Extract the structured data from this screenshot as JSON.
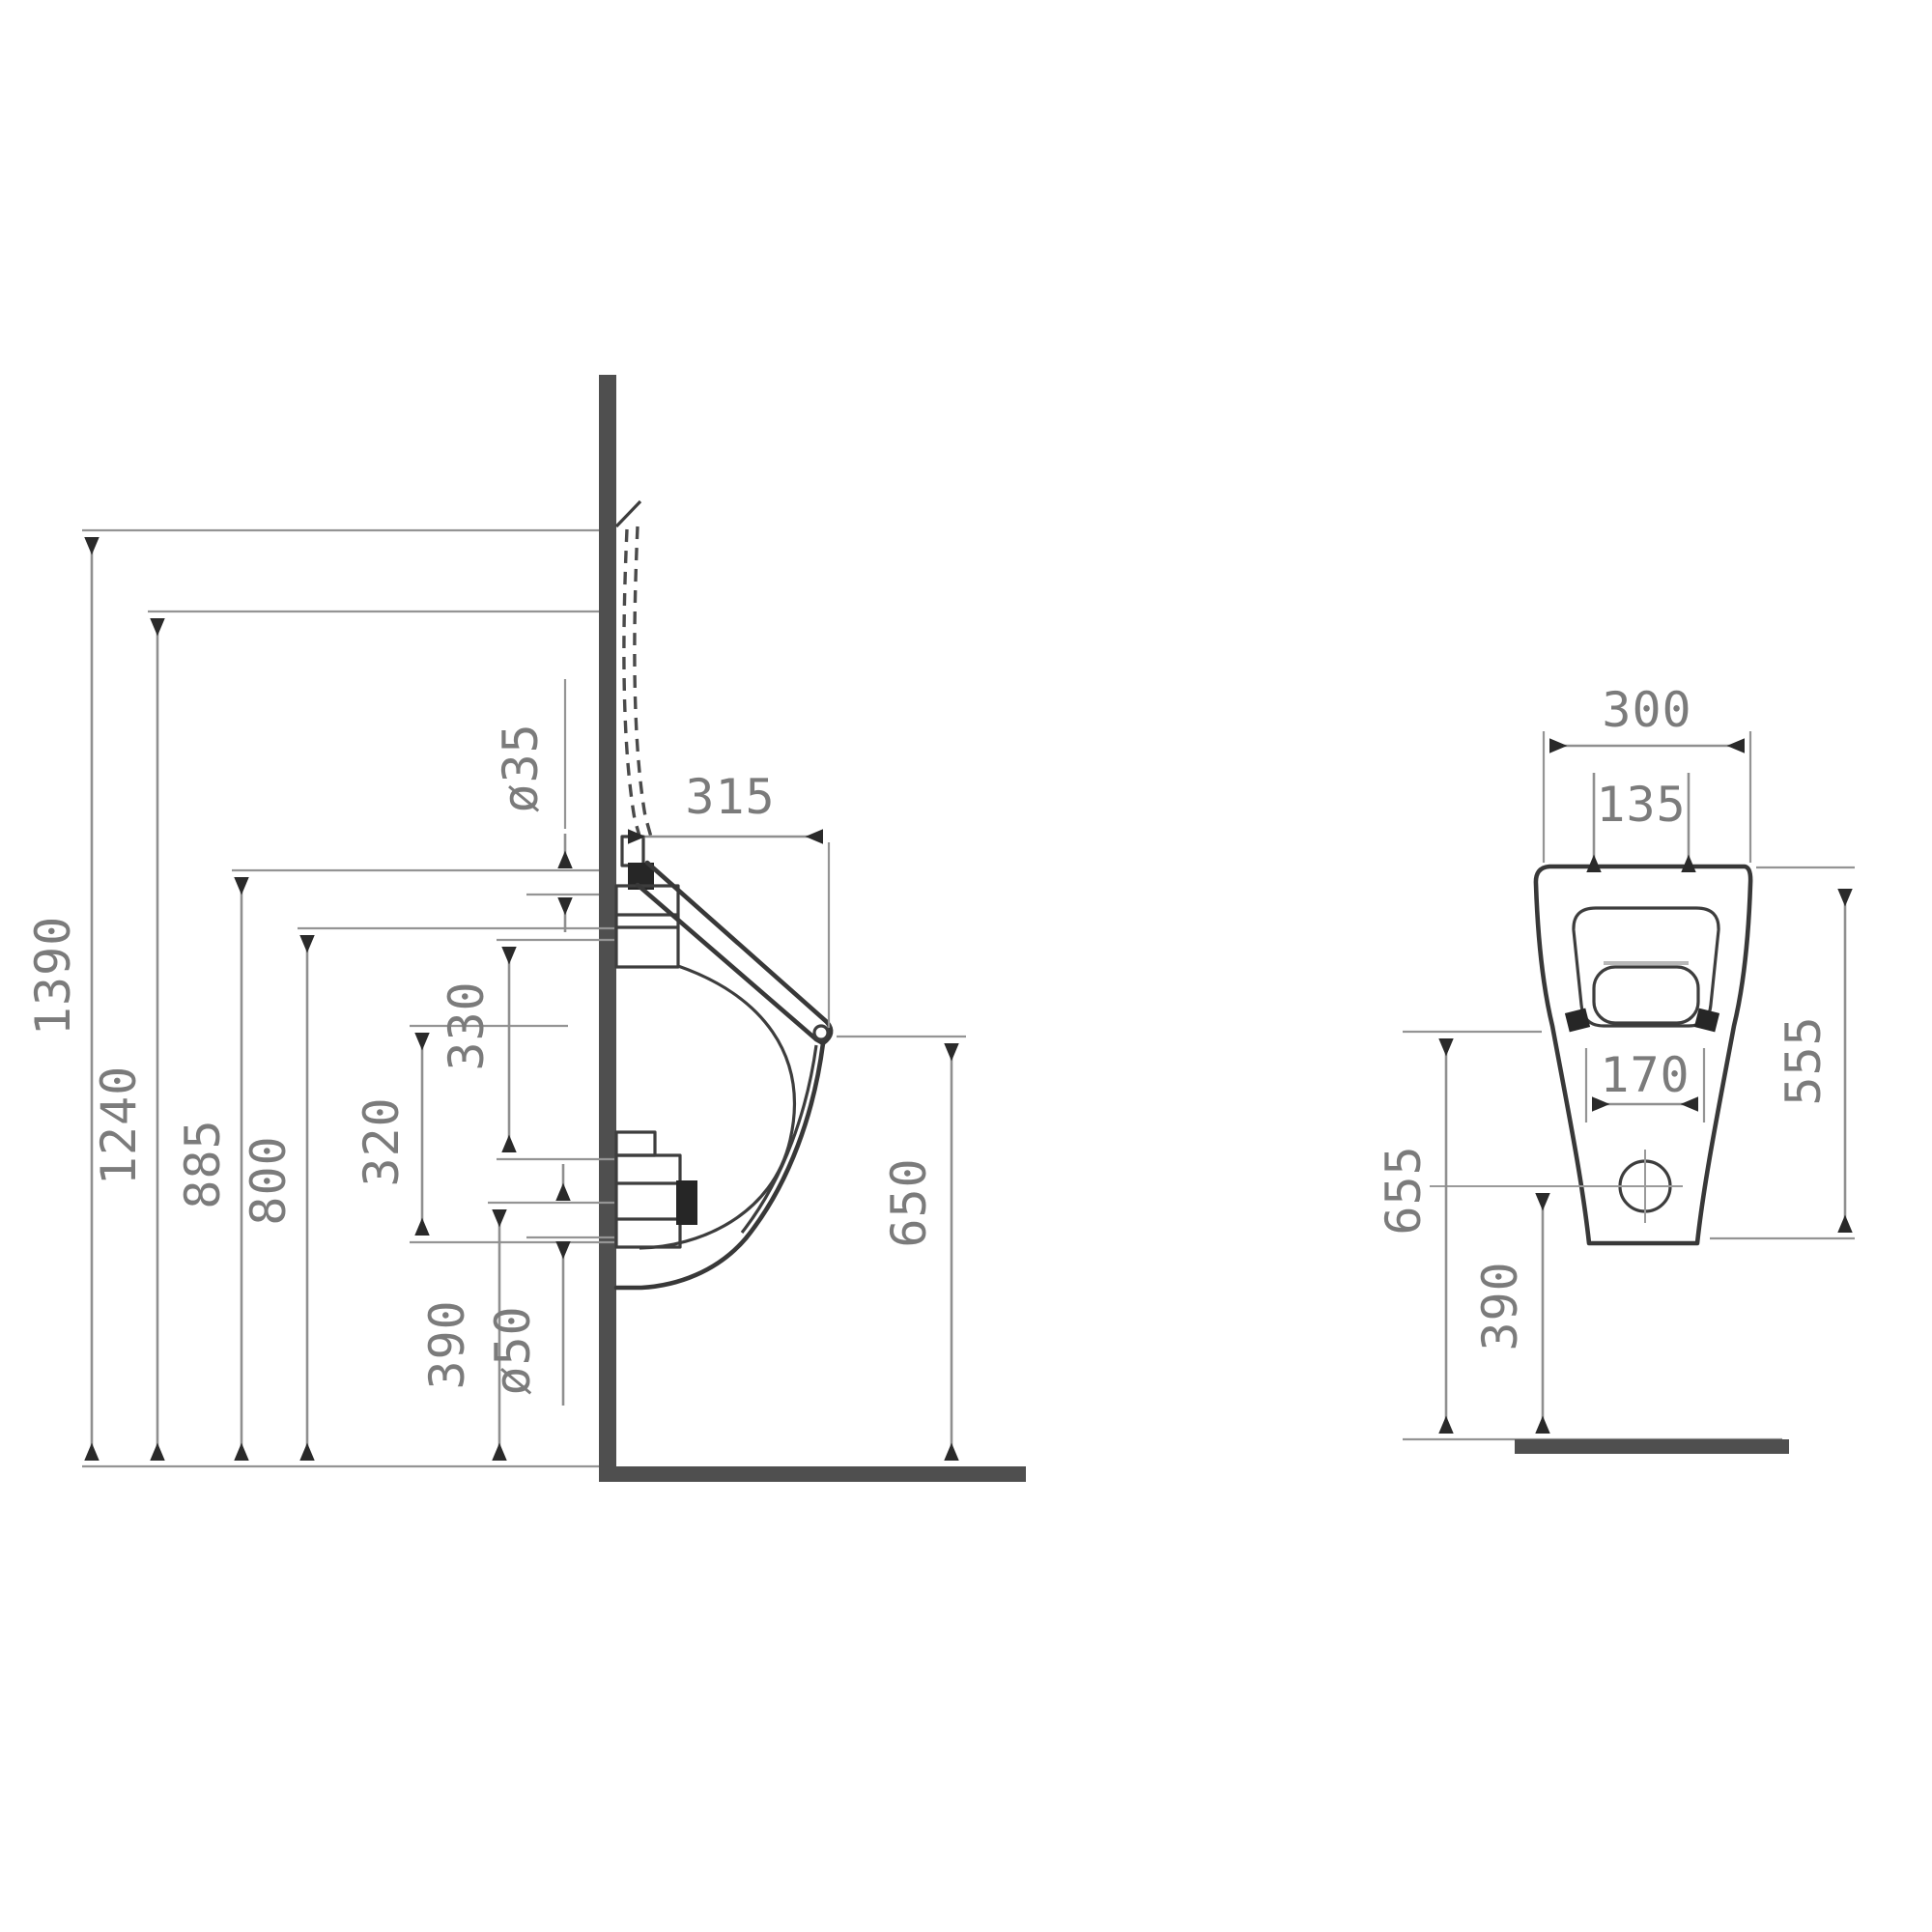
{
  "drawing": {
    "kind": "technical installation drawing",
    "subject": "wall-hung urinal, side section and front elevation with millimetre dimensions",
    "colors": {
      "dimension_line_gray": "#8f8f8f",
      "label_gray": "#7b7b7b",
      "wall_floor_gray": "#4f4f4f",
      "profile_black": "#383838",
      "background": "#ffffff"
    },
    "side_view": {
      "height_1390": "1390",
      "height_1240": "1240",
      "height_885": "885",
      "height_800": "800",
      "offset_320": "320",
      "offset_330": "330",
      "height_390": "390",
      "outlet_diameter": "ø50",
      "inlet_diameter": "ø35",
      "depth_315": "315",
      "height_650": "650"
    },
    "front_view": {
      "width_300": "300",
      "inlet_span_135": "135",
      "outlet_span_170": "170",
      "height_555": "555",
      "height_655": "655",
      "outlet_height_390": "390"
    }
  }
}
